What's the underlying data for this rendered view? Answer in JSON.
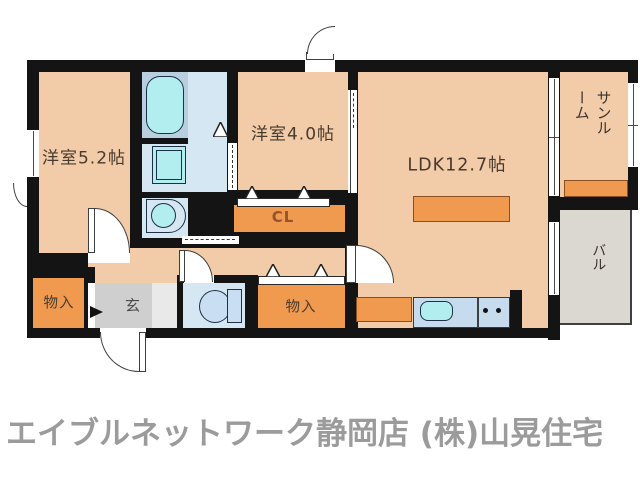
{
  "floorplan": {
    "rooms": {
      "yoshitsu52": {
        "label": "洋室5.2帖"
      },
      "yoshitsu40": {
        "label": "洋室4.0帖"
      },
      "ldk": {
        "label": "LDK12.7帖"
      },
      "sunroom": {
        "label": "サンル\nーム"
      },
      "closet": {
        "label": "CL"
      },
      "storage_left": {
        "label": "物入"
      },
      "storage_right": {
        "label": "物入"
      },
      "entrance": {
        "label": "玄"
      },
      "balcony": {
        "label": "バル"
      }
    },
    "icons": {
      "bathtub": "rounded-rect-tub",
      "washing-machine-pan": "double-square",
      "washbasin": "bowl-in-cabinet",
      "toilet": "bowl-with-tank",
      "kitchen-sink": "rounded-rect-sink",
      "stove-burners": "two-dots",
      "door-swing": "quarter-arc",
      "folding-door": "triangle",
      "entry-step-arrow": "right-triangle"
    },
    "colors": {
      "wall": "#141414",
      "room_floor": "#f2cba8",
      "storage_orange": "#f09a50",
      "bath_floor": "#b7cfdf",
      "wet_floor": "#d4e7f2",
      "fixture_cyan": "#b2edf0",
      "entrance_gray": "#cfcfcf",
      "balcony_gray": "#dbd8d2",
      "footer_gray": "#9b9b9b"
    }
  },
  "footer": {
    "brand_text": "エイブルネットワーク静岡店 (株)山晃住宅"
  }
}
